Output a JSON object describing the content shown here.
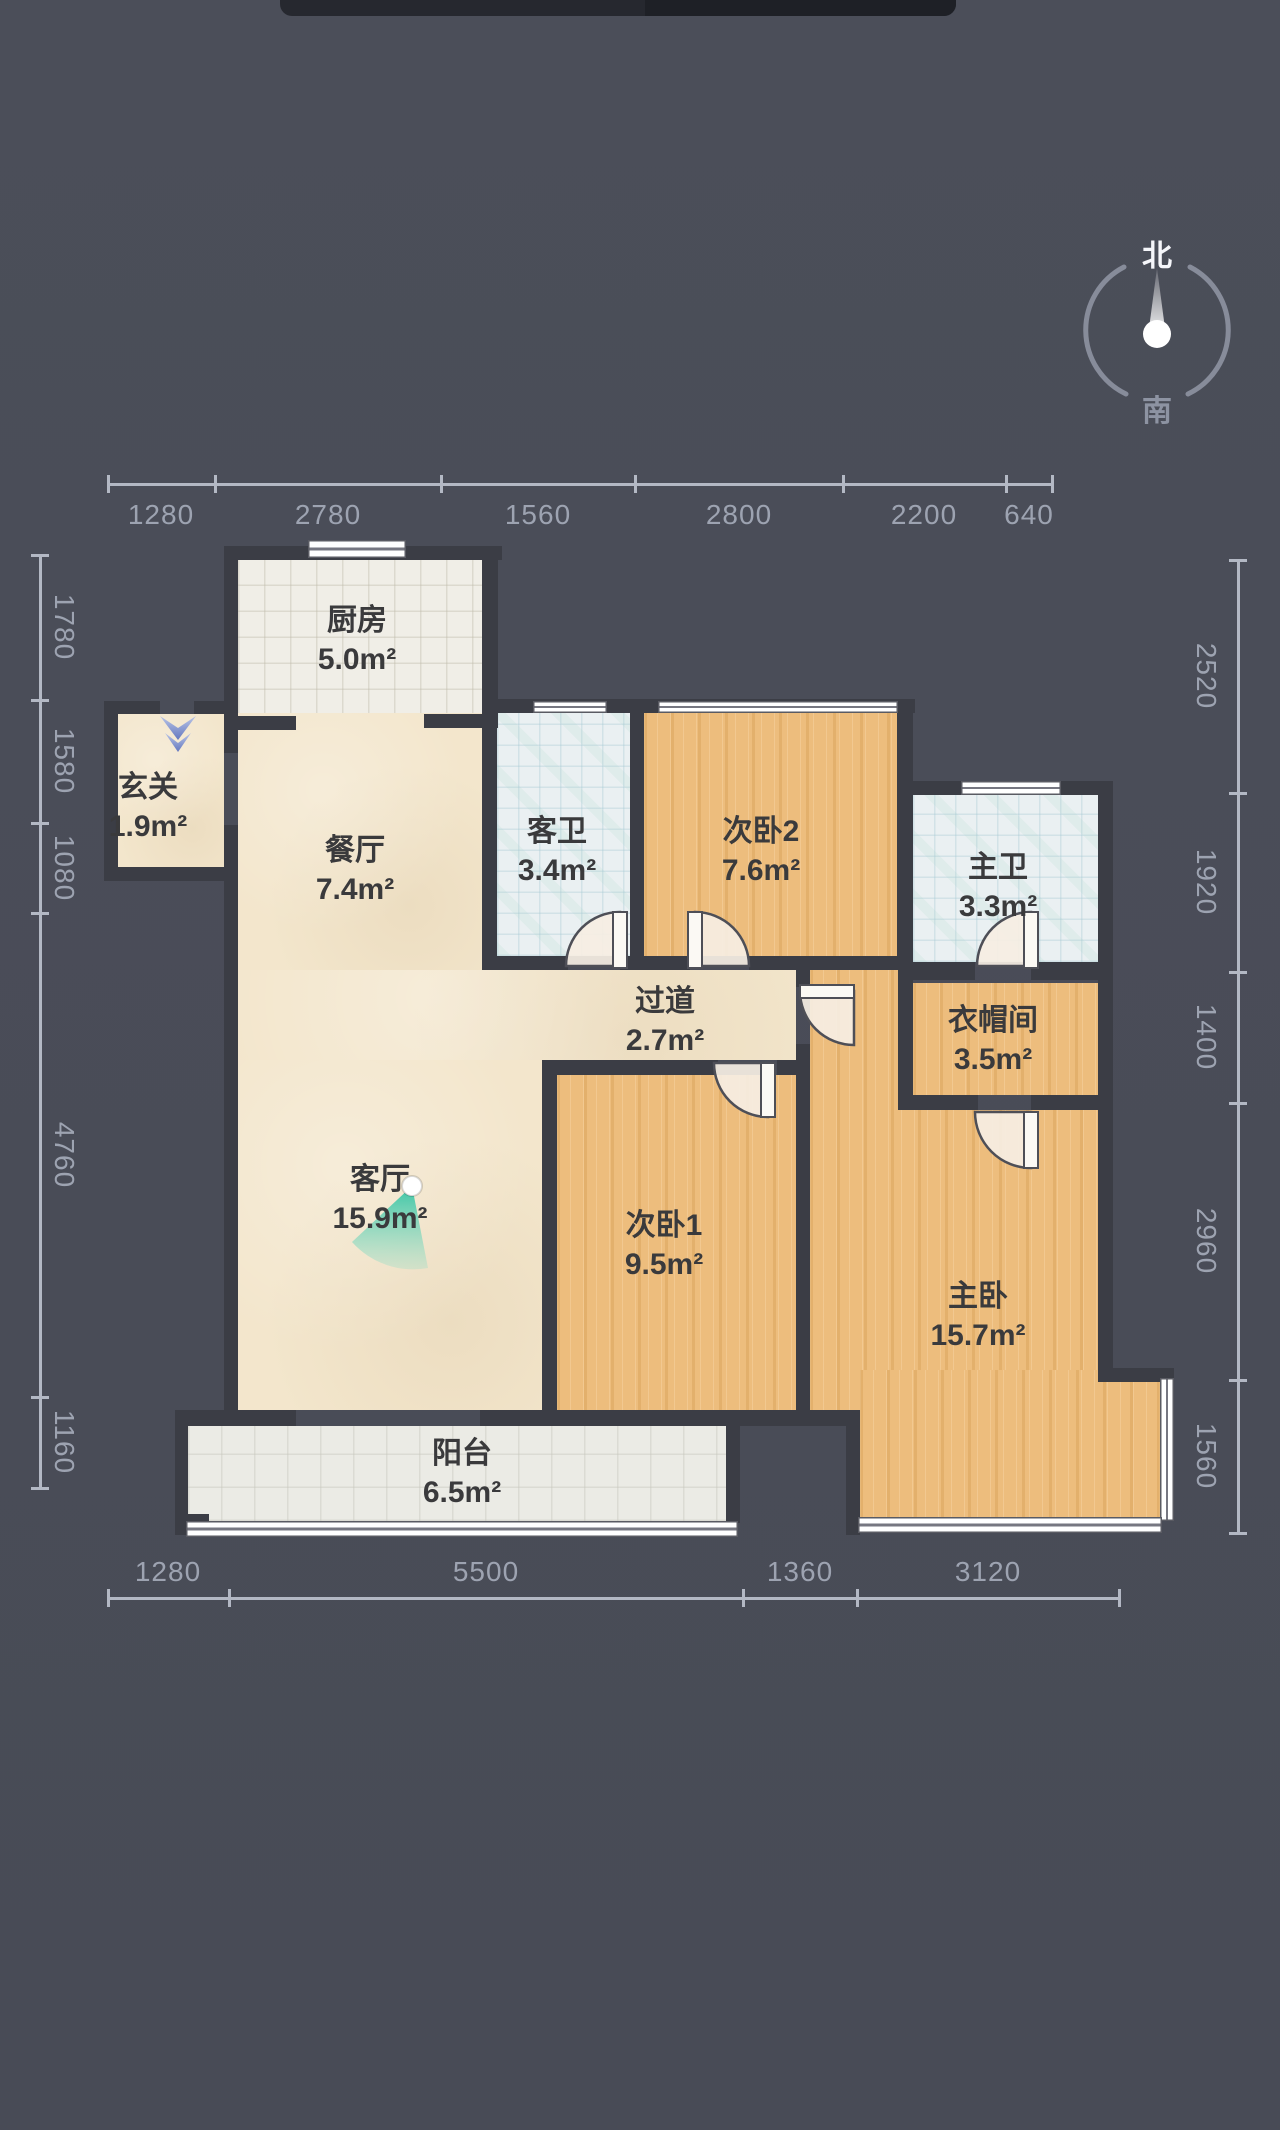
{
  "colors": {
    "background": "#4a4d58",
    "wall": "#3b3d45",
    "wood_floor": "#edbd7d",
    "beige_floor": "#f3e6cc",
    "bath_tile": "#eaf0f2",
    "kitchen_tile": "#f0eee7",
    "balcony_tile": "#ebebe5",
    "dimension_text": "#9da3b1",
    "room_text": "#3a3a3c",
    "view_marker_teal": "#2fc3a2",
    "entry_arrow_blue": "#6377bf",
    "compass_north_text": "#f5f6fa",
    "compass_ring": "#9298a6",
    "top_bar": "#26282f"
  },
  "top_bar": {
    "x": 280,
    "y": 0,
    "w": 676,
    "h": 16
  },
  "compass": {
    "north": "北",
    "south": "南",
    "cx": 1157,
    "cy": 330,
    "r": 71,
    "north_pos": {
      "x": 1157,
      "y": 253
    },
    "south_pos": {
      "x": 1157,
      "y": 408
    },
    "arcs": [
      "M1190,267 A71,71 0 0 1 1188,394",
      "M1126,394 A71,71 0 0 1 1124,267"
    ],
    "needle_cone": "1148,336 1166,336 1157,268",
    "ball": {
      "cx": 1157,
      "cy": 334,
      "r": 14
    }
  },
  "plan": {
    "floors": [
      {
        "name": "floor-kitchen",
        "cls": "f-tilewarm",
        "x": 238,
        "y": 560,
        "w": 246,
        "h": 156
      },
      {
        "name": "floor-entry",
        "cls": "f-beige",
        "x": 118,
        "y": 714,
        "w": 106,
        "h": 153
      },
      {
        "name": "floor-dining",
        "cls": "f-beige",
        "x": 238,
        "y": 713,
        "w": 244,
        "h": 257
      },
      {
        "name": "floor-corridor",
        "cls": "f-beige",
        "x": 238,
        "y": 970,
        "w": 558,
        "h": 90
      },
      {
        "name": "floor-living",
        "cls": "f-beige",
        "x": 238,
        "y": 1060,
        "w": 304,
        "h": 350
      },
      {
        "name": "floor-guest-bath",
        "cls": "f-tilecool",
        "x": 497,
        "y": 713,
        "w": 133,
        "h": 243
      },
      {
        "name": "floor-bedroom2",
        "cls": "f-wood",
        "x": 644,
        "y": 713,
        "w": 253,
        "h": 243
      },
      {
        "name": "floor-master-bath",
        "cls": "f-tilecool",
        "x": 913,
        "y": 795,
        "w": 185,
        "h": 167
      },
      {
        "name": "floor-closet",
        "cls": "f-wood",
        "x": 913,
        "y": 983,
        "w": 185,
        "h": 112
      },
      {
        "name": "floor-bedroom1",
        "cls": "f-wood",
        "x": 557,
        "y": 1075,
        "w": 239,
        "h": 335
      },
      {
        "name": "floor-master-a",
        "cls": "f-wood",
        "x": 810,
        "y": 970,
        "w": 88,
        "h": 140
      },
      {
        "name": "floor-master-b",
        "cls": "f-wood",
        "x": 810,
        "y": 1110,
        "w": 288,
        "h": 260
      },
      {
        "name": "floor-master-c",
        "cls": "f-wood",
        "x": 810,
        "y": 1370,
        "w": 288,
        "h": 40
      },
      {
        "name": "floor-master-d",
        "cls": "f-wood",
        "x": 860,
        "y": 1370,
        "w": 300,
        "h": 149
      },
      {
        "name": "floor-balcony",
        "cls": "f-tilegray",
        "x": 188,
        "y": 1426,
        "w": 538,
        "h": 95
      }
    ],
    "walls": [
      [
        224,
        546,
        278,
        14
      ],
      [
        224,
        546,
        14,
        170
      ],
      [
        104,
        701,
        56,
        13
      ],
      [
        194,
        701,
        44,
        13
      ],
      [
        104,
        701,
        14,
        180
      ],
      [
        104,
        867,
        134,
        14
      ],
      [
        224,
        713,
        14,
        40
      ],
      [
        224,
        825,
        14,
        56
      ],
      [
        482,
        546,
        16,
        168
      ],
      [
        482,
        699,
        433,
        14
      ],
      [
        224,
        716,
        72,
        14
      ],
      [
        424,
        714,
        74,
        14
      ],
      [
        482,
        712,
        15,
        258
      ],
      [
        630,
        712,
        14,
        258
      ],
      [
        897,
        699,
        16,
        271
      ],
      [
        482,
        956,
        86,
        14
      ],
      [
        620,
        956,
        70,
        14
      ],
      [
        749,
        956,
        164,
        14
      ],
      [
        913,
        781,
        200,
        14
      ],
      [
        1098,
        781,
        15,
        601
      ],
      [
        898,
        781,
        15,
        329
      ],
      [
        913,
        962,
        62,
        18
      ],
      [
        1031,
        962,
        67,
        18
      ],
      [
        898,
        1095,
        80,
        15
      ],
      [
        1031,
        1095,
        67,
        15
      ],
      [
        796,
        970,
        14,
        17
      ],
      [
        796,
        1044,
        14,
        380
      ],
      [
        542,
        1060,
        176,
        15
      ],
      [
        777,
        1060,
        33,
        15
      ],
      [
        542,
        1060,
        15,
        362
      ],
      [
        224,
        867,
        14,
        557
      ],
      [
        175,
        1410,
        121,
        16
      ],
      [
        480,
        1410,
        380,
        16
      ],
      [
        175,
        1410,
        13,
        113
      ],
      [
        175,
        1514,
        34,
        21
      ],
      [
        726,
        1410,
        14,
        113
      ],
      [
        846,
        1410,
        14,
        125
      ],
      [
        1098,
        1368,
        76,
        14
      ],
      [
        1160,
        1418,
        14,
        28
      ]
    ],
    "windows": [
      {
        "name": "window-kitchen-north",
        "dir": "h",
        "x": 308,
        "y": 540,
        "w": 98,
        "h": 18
      },
      {
        "name": "window-guest-bath-north",
        "dir": "h",
        "x": 533,
        "y": 701,
        "w": 74,
        "h": 12
      },
      {
        "name": "window-bedroom2-north",
        "dir": "h",
        "x": 658,
        "y": 701,
        "w": 240,
        "h": 12
      },
      {
        "name": "window-master-bath-north",
        "dir": "h",
        "x": 961,
        "y": 781,
        "w": 100,
        "h": 14
      },
      {
        "name": "window-master-east",
        "dir": "v",
        "x": 1160,
        "y": 1378,
        "w": 14,
        "h": 143
      },
      {
        "name": "window-master-south",
        "dir": "h",
        "x": 858,
        "y": 1517,
        "w": 304,
        "h": 16
      },
      {
        "name": "window-balcony-south",
        "dir": "h",
        "x": 186,
        "y": 1521,
        "w": 552,
        "h": 16
      }
    ],
    "doors": [
      {
        "name": "door-guest-bath",
        "leaf": [
          613,
          912,
          14,
          56
        ],
        "pie": "M620,966 L620,912 A54,54 0 0 0 566,966 Z"
      },
      {
        "name": "door-bedroom2",
        "leaf": [
          688,
          912,
          14,
          56
        ],
        "pie": "M695,966 L695,912 A54,54 0 0 1 749,966 Z"
      },
      {
        "name": "door-master-bath",
        "leaf": [
          1024,
          912,
          14,
          56
        ],
        "pie": "M1031,966 L1031,912 A54,54 0 0 0 977,966 Z"
      },
      {
        "name": "door-closet",
        "leaf": [
          1024,
          1112,
          14,
          56
        ],
        "pie": "M1031,1112 L1031,1168 A56,56 0 0 1 975,1112 Z"
      },
      {
        "name": "door-bedroom1",
        "leaf": [
          761,
          1063,
          14,
          54
        ],
        "pie": "M768,1063 L768,1117 A54,54 0 0 1 714,1063 Z"
      },
      {
        "name": "door-master",
        "leaf": [
          800,
          985,
          54,
          13
        ],
        "pie": "M854,991 L800,991 A54,54 0 0 0 854,1045 Z"
      }
    ],
    "rooms": [
      {
        "name": "room-kitchen",
        "label": "厨房",
        "area": "5.0m²",
        "cx": 357,
        "cy": 640
      },
      {
        "name": "room-entry",
        "label": "玄关",
        "area": "1.9m²",
        "cx": 148,
        "cy": 807
      },
      {
        "name": "room-dining",
        "label": "餐厅",
        "area": "7.4m²",
        "cx": 355,
        "cy": 870
      },
      {
        "name": "room-guest-bath",
        "label": "客卫",
        "area": "3.4m²",
        "cx": 557,
        "cy": 851
      },
      {
        "name": "room-bedroom2",
        "label": "次卧2",
        "area": "7.6m²",
        "cx": 761,
        "cy": 851
      },
      {
        "name": "room-master-bath",
        "label": "主卫",
        "area": "3.3m²",
        "cx": 998,
        "cy": 887
      },
      {
        "name": "room-closet",
        "label": "衣帽间",
        "area": "3.5m²",
        "cx": 993,
        "cy": 1040
      },
      {
        "name": "room-corridor",
        "label": "过道",
        "area": "2.7m²",
        "cx": 665,
        "cy": 1021
      },
      {
        "name": "room-living",
        "label": "客厅",
        "area": "15.9m²",
        "cx": 380,
        "cy": 1199
      },
      {
        "name": "room-bedroom1",
        "label": "次卧1",
        "area": "9.5m²",
        "cx": 664,
        "cy": 1245
      },
      {
        "name": "room-master",
        "label": "主卧",
        "area": "15.7m²",
        "cx": 978,
        "cy": 1316
      },
      {
        "name": "room-balcony",
        "label": "阳台",
        "area": "6.5m²",
        "cx": 462,
        "cy": 1473
      }
    ],
    "view_marker": {
      "pie": "M412,1186 L352,1242 A82,82 0 0 0 428,1268 Z",
      "dot": {
        "cx": 412,
        "cy": 1186,
        "r": 10
      }
    },
    "entry_arrow": {
      "polys": [
        "160,716 178,728 196,716 178,740",
        "165,733 178,743 191,733 178,752"
      ]
    }
  },
  "dimensions": {
    "top": {
      "axis": "h",
      "line": {
        "x": 108,
        "y": 484,
        "len": 944
      },
      "ticks": [
        108,
        215,
        441,
        635,
        843,
        1006,
        1052
      ],
      "labels": [
        {
          "text": "1280",
          "cx": 161,
          "cy": 515
        },
        {
          "text": "2780",
          "cx": 328,
          "cy": 515
        },
        {
          "text": "1560",
          "cx": 538,
          "cy": 515
        },
        {
          "text": "2800",
          "cx": 739,
          "cy": 515
        },
        {
          "text": "2200",
          "cx": 924,
          "cy": 515
        },
        {
          "text": "640",
          "cx": 1029,
          "cy": 515
        }
      ]
    },
    "bottom": {
      "axis": "h",
      "line": {
        "x": 108,
        "y": 1598,
        "len": 1011
      },
      "ticks": [
        108,
        229,
        743,
        857,
        1119
      ],
      "labels": [
        {
          "text": "1280",
          "cx": 168,
          "cy": 1572
        },
        {
          "text": "5500",
          "cx": 486,
          "cy": 1572
        },
        {
          "text": "1360",
          "cx": 800,
          "cy": 1572
        },
        {
          "text": "3120",
          "cx": 988,
          "cy": 1572
        }
      ]
    },
    "left": {
      "axis": "v",
      "line": {
        "x": 40,
        "y": 555,
        "len": 933
      },
      "ticks": [
        555,
        700,
        823,
        913,
        1397,
        1488
      ],
      "labels": [
        {
          "text": "1780",
          "cx": 64,
          "cy": 627
        },
        {
          "text": "1580",
          "cx": 64,
          "cy": 761
        },
        {
          "text": "1080",
          "cx": 64,
          "cy": 868
        },
        {
          "text": "4760",
          "cx": 64,
          "cy": 1155
        },
        {
          "text": "1160",
          "cx": 64,
          "cy": 1442
        }
      ]
    },
    "right": {
      "axis": "v",
      "line": {
        "x": 1238,
        "y": 560,
        "len": 973
      },
      "ticks": [
        560,
        793,
        972,
        1103,
        1380,
        1533
      ],
      "labels": [
        {
          "text": "2520",
          "cx": 1206,
          "cy": 676
        },
        {
          "text": "1920",
          "cx": 1206,
          "cy": 882
        },
        {
          "text": "1400",
          "cx": 1206,
          "cy": 1037
        },
        {
          "text": "2960",
          "cx": 1206,
          "cy": 1241
        },
        {
          "text": "1560",
          "cx": 1206,
          "cy": 1456
        }
      ]
    }
  }
}
